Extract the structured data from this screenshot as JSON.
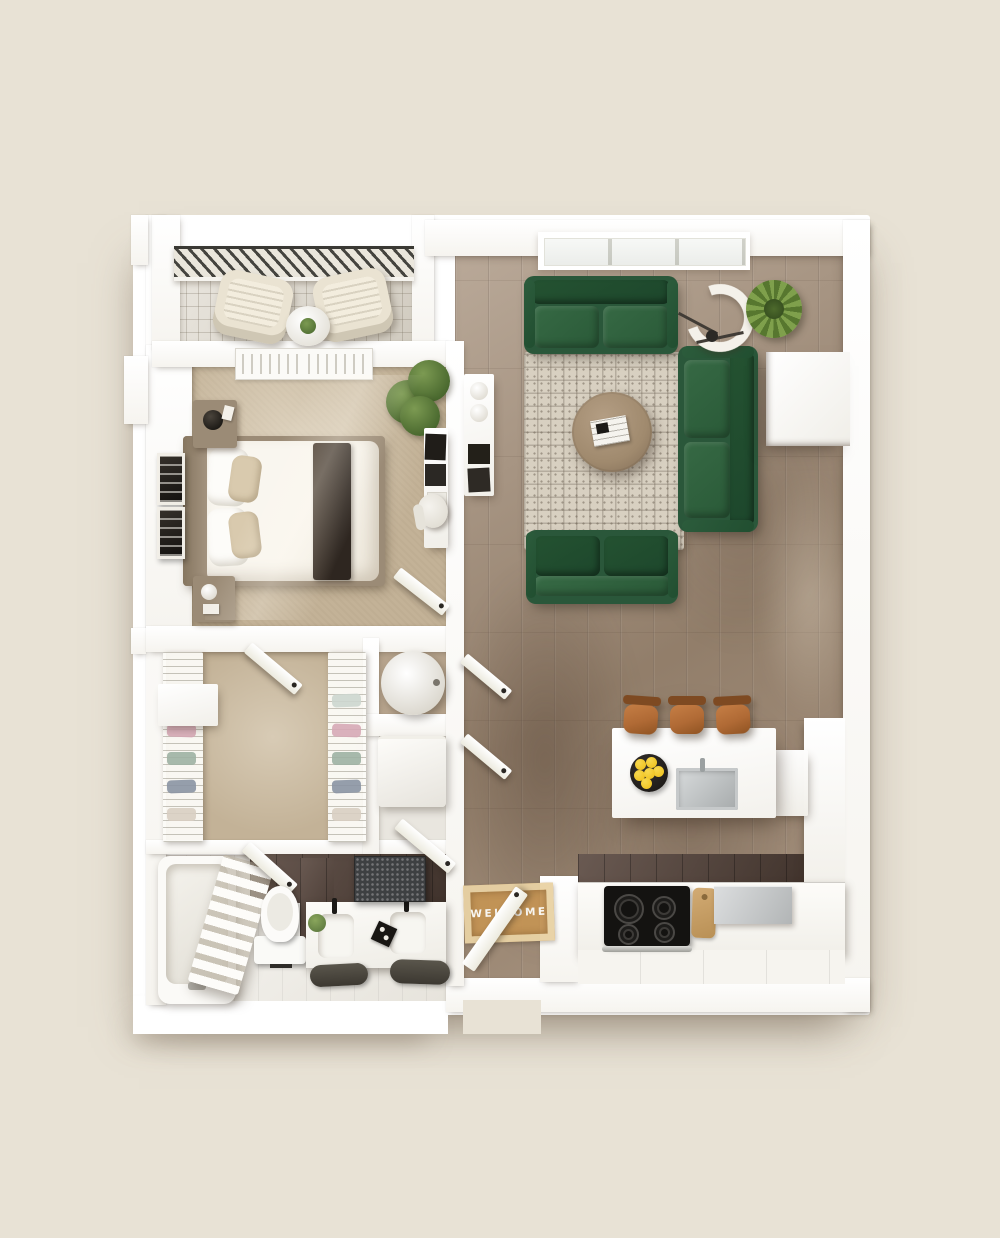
{
  "scene": {
    "kind": "3d-floor-plan-top-down-render",
    "description": "Photorealistic dollhouse-style top view of a one-bedroom apartment on a beige background",
    "welcome_mat": {
      "text": "WELCOME"
    }
  },
  "colors": {
    "bg": "#e8e2d5",
    "wall": "#ffffff",
    "wood": "#a28c76",
    "wood-dark": "#7c6753",
    "carpet": "#c3b297",
    "balcony-tile": "#dcd6ca",
    "tile-dark": "#55433a",
    "bath-floor": "#f2f0ea",
    "sofa": "#2a573a",
    "sofa-dark": "#1d472c",
    "sofa-light": "#366944",
    "rug": "#d8d0c1",
    "table-wood": "#a08a6e",
    "stool": "#b06a35",
    "stool-dark": "#7e4a22",
    "lemon": "#f1c627",
    "plant": "#5f7d3c",
    "plant-dark": "#3c5722",
    "mat": "#c49455",
    "mat-border": "#e9d2a4",
    "mat-text": "#fdfcf8",
    "furn-wood": "#9b8b76",
    "dark": "#201d19",
    "steel": "#bfc2c3"
  },
  "rooms": [
    {
      "id": "balcony",
      "name": "Balcony",
      "furniture": [
        "patio chair",
        "patio chair",
        "round side table with plant",
        "railing"
      ]
    },
    {
      "id": "bedroom",
      "name": "Bedroom",
      "furniture": [
        "double bed with dark throw",
        "nightstand with lamp",
        "nightstand with lamp",
        "wall art frames",
        "potted plant",
        "dresser console",
        "chair",
        "ceiling vent"
      ]
    },
    {
      "id": "walk-in-closet",
      "name": "Walk-in Closet",
      "furniture": [
        "wire shelving with clothes (left)",
        "wire shelving with clothes (right)",
        "corner drawer unit"
      ]
    },
    {
      "id": "utility-closets",
      "name": "Utility Closets",
      "furniture": [
        "water heater",
        "washer"
      ]
    },
    {
      "id": "bathroom",
      "name": "Bathroom",
      "furniture": [
        "bathtub",
        "towel ladder",
        "toilet",
        "double-sink vanity",
        "dark mirror",
        "bath towels",
        "small plant"
      ]
    },
    {
      "id": "living-room",
      "name": "Living Room",
      "furniture": [
        "green loveseat (window)",
        "green sofa (right wall)",
        "green loveseat (south)",
        "round wood coffee table with magazines",
        "patterned area rug",
        "arc floor lamp",
        "potted plant",
        "white media cabinet",
        "wall console"
      ]
    },
    {
      "id": "kitchen",
      "name": "Kitchen",
      "furniture": [
        "island with sink and faucet",
        "bowl of lemons",
        "bar stool",
        "bar stool",
        "bar stool",
        "electric range with oven",
        "cutting board",
        "stainless counter",
        "lower cabinets",
        "tall cabinet column"
      ]
    },
    {
      "id": "entry",
      "name": "Entry",
      "furniture": [
        "welcome door mat",
        "front door"
      ]
    }
  ]
}
